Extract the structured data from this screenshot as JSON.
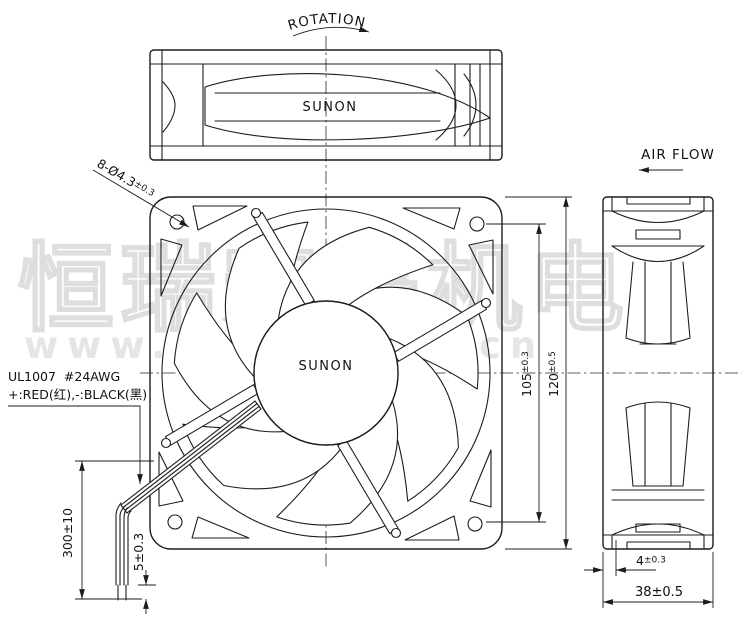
{
  "drawing": {
    "rotation_label": "ROTATION",
    "air_flow_label": "AIR FLOW",
    "top_view_brand": "SUNON",
    "front_view_brand": "SUNON",
    "dimensions": {
      "mounting_holes": {
        "main": "8-Ø4.3",
        "tol": "±0.3"
      },
      "hole_pitch": {
        "main": "105",
        "tol": "±0.3"
      },
      "frame_size": {
        "main": "120",
        "tol": "±0.5"
      },
      "flange_offset": {
        "main": "4",
        "tol": "±0.3"
      },
      "depth": "38±0.5",
      "lead_length": "300±10",
      "strip_length": "5±0.3"
    },
    "wire_spec": {
      "line1": "UL1007 #24AWG",
      "line2": "+:RED(红),-:BLACK(黑)"
    },
    "watermark": {
      "cn": "恒瑞宏晟机电",
      "url": "www.bjhengrui.cn"
    },
    "colors": {
      "line": "#1d1d1d",
      "watermark": "#dedede",
      "background": "#ffffff"
    }
  }
}
